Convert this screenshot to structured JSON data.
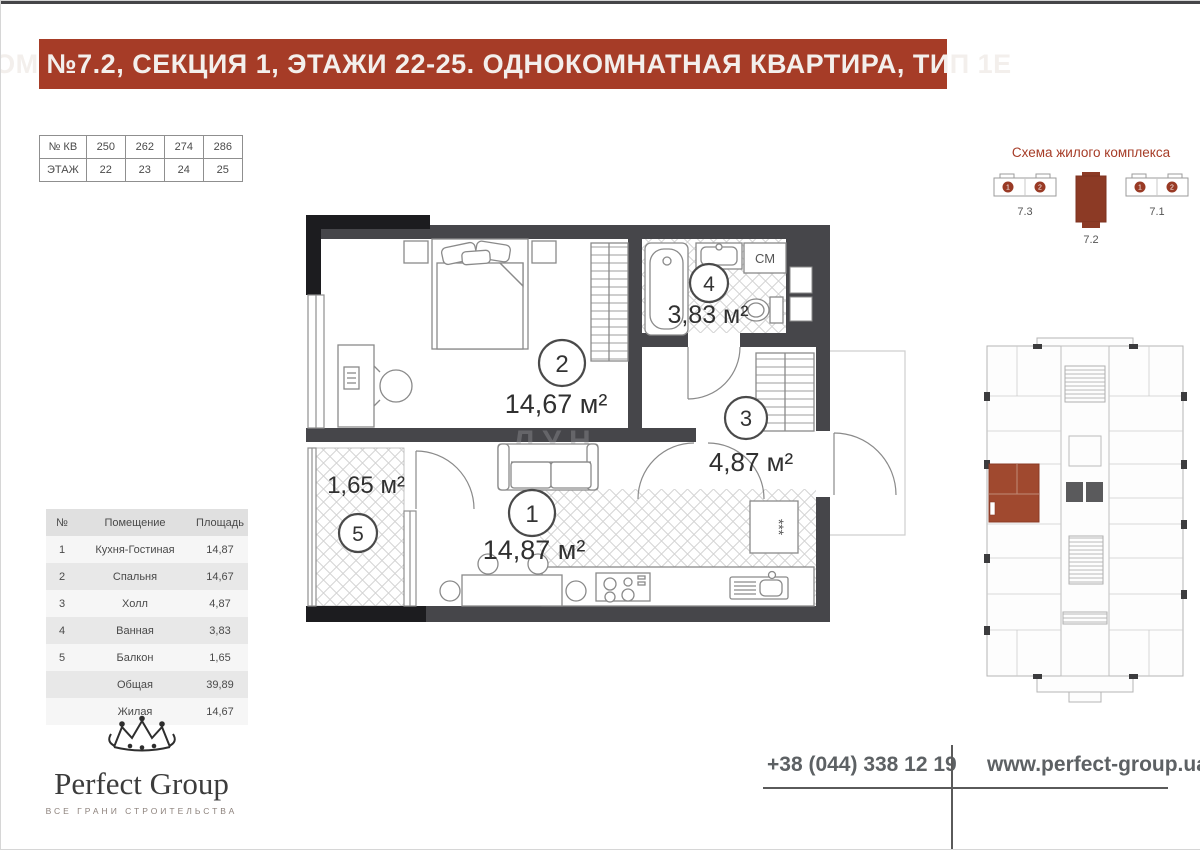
{
  "header": {
    "title": "ДОМ №7.2, СЕКЦИЯ 1, ЭТАЖИ 22-25. ОДНОКОМНАТНАЯ КВАРТИРА, ТИП 1Е"
  },
  "apartments_table": {
    "row1_label": "№ КВ",
    "row1_values": [
      "250",
      "262",
      "274",
      "286"
    ],
    "row2_label": "ЭТАЖ",
    "row2_values": [
      "22",
      "23",
      "24",
      "25"
    ]
  },
  "complex_scheme": {
    "title": "Схема жилого комплекса",
    "buildings": [
      {
        "label": "7.3",
        "highlighted": false,
        "sections": [
          "1",
          "2"
        ]
      },
      {
        "label": "7.2",
        "highlighted": true,
        "sections": []
      },
      {
        "label": "7.1",
        "highlighted": false,
        "sections": [
          "1",
          "2"
        ]
      }
    ]
  },
  "floor_plan": {
    "watermark": "ЛУН",
    "cm_label": "СМ",
    "fridge_label": "***",
    "rooms": [
      {
        "number": "1",
        "area_label": "14,87 м²"
      },
      {
        "number": "2",
        "area_label": "14,67 м²"
      },
      {
        "number": "3",
        "area_label": "4,87 м²"
      },
      {
        "number": "4",
        "area_label": "3,83 м²"
      },
      {
        "number": "5",
        "area_label": "1,65 м²"
      }
    ]
  },
  "rooms_table": {
    "headers": [
      "№",
      "Помещение",
      "Площадь"
    ],
    "rows": [
      {
        "num": "1",
        "name": "Кухня-Гостиная",
        "area": "14,87"
      },
      {
        "num": "2",
        "name": "Спальня",
        "area": "14,67"
      },
      {
        "num": "3",
        "name": "Холл",
        "area": "4,87"
      },
      {
        "num": "4",
        "name": "Ванная",
        "area": "3,83"
      },
      {
        "num": "5",
        "name": "Балкон",
        "area": "1,65"
      },
      {
        "num": "",
        "name": "Общая",
        "area": "39,89"
      },
      {
        "num": "",
        "name": "Жилая",
        "area": "14,67"
      }
    ]
  },
  "footer": {
    "brand": "Perfect Group",
    "tagline": "ВСЕ ГРАНИ СТРОИТЕЛЬСТВА",
    "phone": "+38 (044) 338 12 19",
    "website": "www.perfect-group.ua"
  },
  "colors": {
    "accent": "#a63c27",
    "wall": "#46464a",
    "highlight_unit": "#a0492f"
  }
}
